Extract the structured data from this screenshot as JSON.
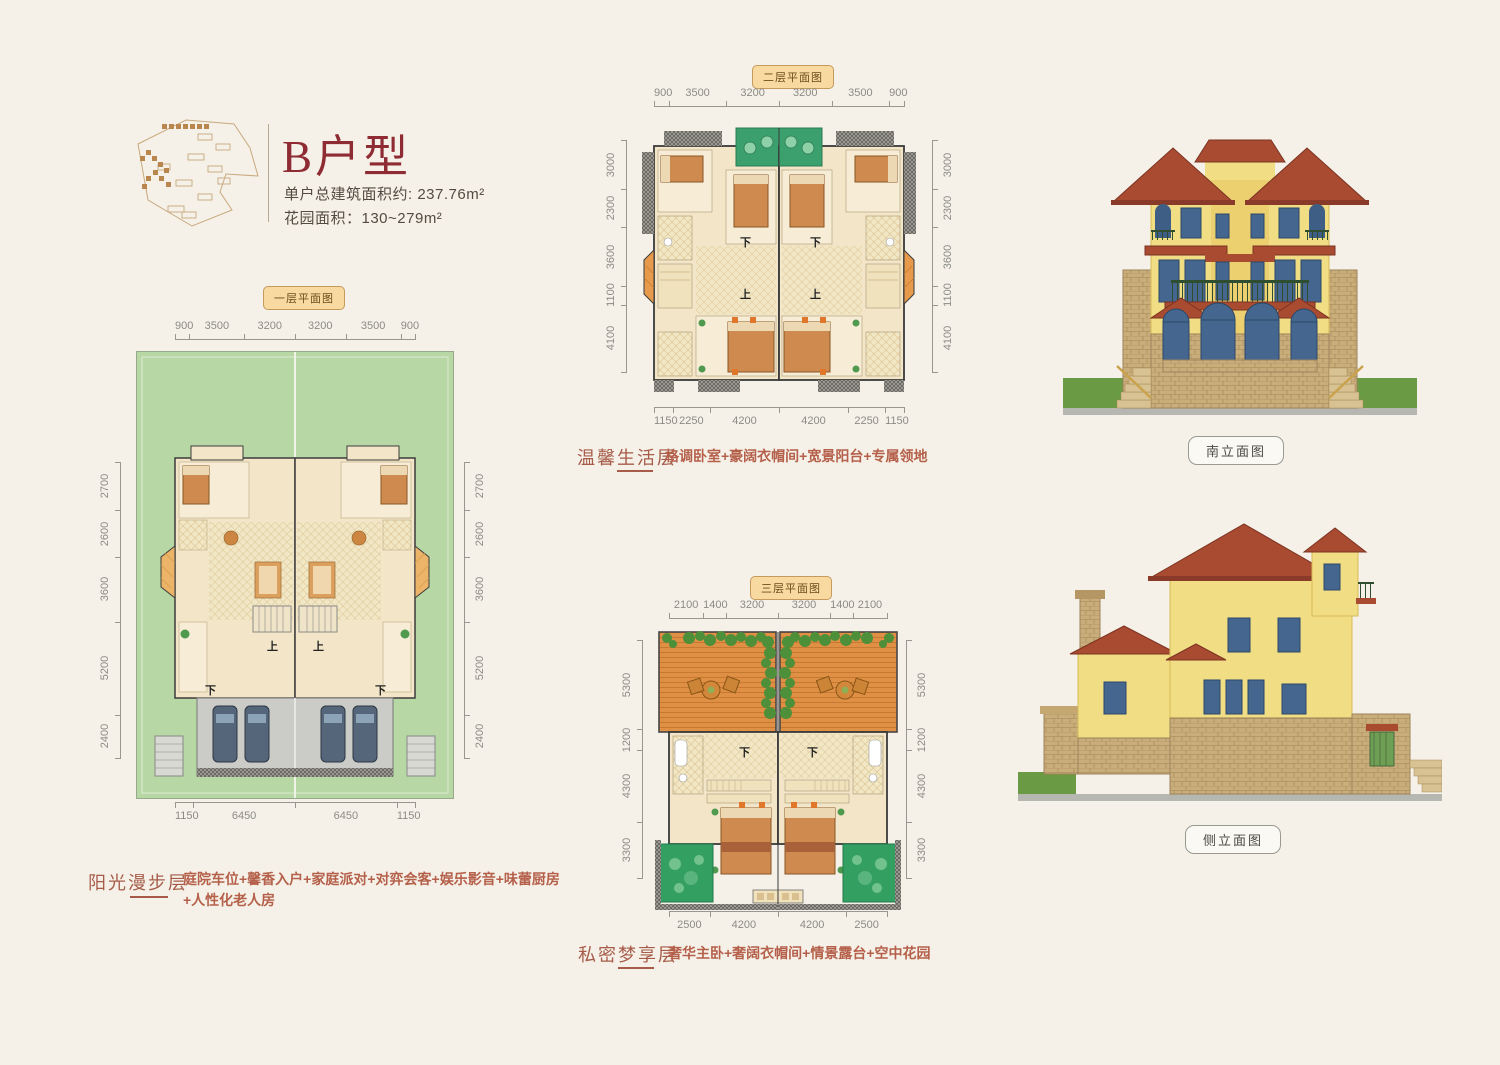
{
  "title_block": {
    "title": "B户型",
    "total_area": "单户总建筑面积约: 237.76m²",
    "garden_area": "花园面积：130~279m²"
  },
  "stair_labels": {
    "up": "上",
    "down": "下"
  },
  "floor1": {
    "badge": "一层平面图",
    "dims_top": [
      "900",
      "3500",
      "3200",
      "3200",
      "3500",
      "900"
    ],
    "dims_left": [
      "2700",
      "2600",
      "3600",
      "5200",
      "2400"
    ],
    "dims_right": [
      "2700",
      "2600",
      "3600",
      "5200",
      "2400"
    ],
    "dims_bottom": [
      "1150",
      "6450",
      "6450",
      "1150"
    ],
    "layer_name": "阳光漫步层",
    "features_line1": "庭院车位+馨香入户+家庭派对+对弈会客+娱乐影音+味蕾厨房",
    "features_line2": "+人性化老人房"
  },
  "floor2": {
    "badge": "二层平面图",
    "dims_top": [
      "900",
      "3500",
      "3200",
      "3200",
      "3500",
      "900"
    ],
    "dims_left": [
      "3000",
      "2300",
      "3600",
      "1100",
      "4100"
    ],
    "dims_right": [
      "3000",
      "2300",
      "3600",
      "1100",
      "4100"
    ],
    "dims_bottom": [
      "1150",
      "2250",
      "4200",
      "4200",
      "2250",
      "1150"
    ],
    "layer_name": "温馨生活层",
    "features": "格调卧室+豪阔衣帽间+宽景阳台+专属领地"
  },
  "floor3": {
    "badge": "三层平面图",
    "dims_top": [
      "2100",
      "1400",
      "3200",
      "3200",
      "1400",
      "2100"
    ],
    "dims_left": [
      "5300",
      "1200",
      "4300",
      "3300"
    ],
    "dims_right": [
      "5300",
      "1200",
      "4300",
      "3300"
    ],
    "dims_bottom": [
      "2500",
      "4200",
      "4200",
      "2500"
    ],
    "layer_name": "私密梦享层",
    "features": "奢华主卧+奢阔衣帽间+情景露台+空中花园"
  },
  "elevations": {
    "south_label": "南立面图",
    "side_label": "侧立面图"
  },
  "colors": {
    "page_bg": "#f5f1e8",
    "title_red": "#8e2b33",
    "badge_bg": "#f8d99f",
    "badge_border": "#c59a5c",
    "dim_gray": "#8b8b86",
    "layer_red": "#a65c49",
    "feature_red": "#b5604a",
    "roof_terracotta": "#a84b31",
    "wall_yellow": "#f1dd84",
    "window_blue": "#44668f",
    "garden_green": "#b7d7a5",
    "balcony_green": "#3ba06e",
    "terrace_orange": "#e09045"
  }
}
